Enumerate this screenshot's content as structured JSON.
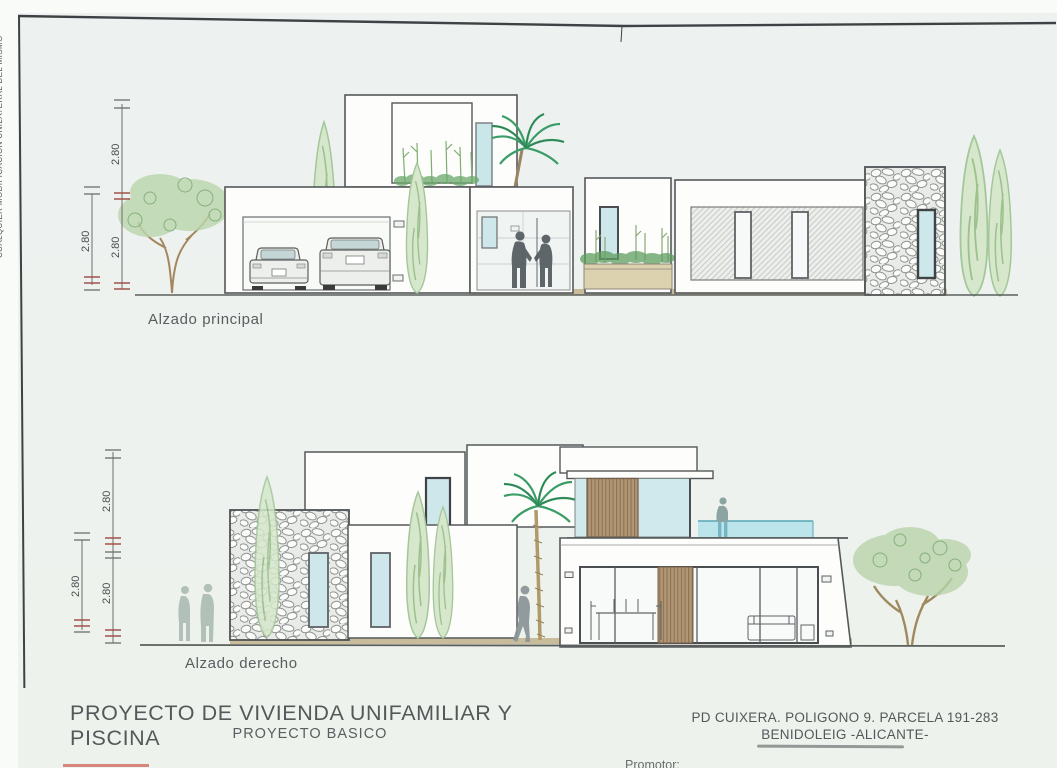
{
  "sheet": {
    "margin_text": "CUALQUIER MODIFICACION UNILATERAL DEL MISMO"
  },
  "elevation1": {
    "label": "Alzado principal",
    "dim_upper": "2.80",
    "dim_lower": "2.80",
    "dim_left": "2.80"
  },
  "elevation2": {
    "label": "Alzado derecho",
    "dim_upper": "2.80",
    "dim_lower": "2.80",
    "dim_left": "2.80"
  },
  "title_block": {
    "title": "PROYECTO DE VIVIENDA UNIFAMILIAR Y PISCINA",
    "subtitle": "PROYECTO BASICO",
    "location_line1": "PD CUIXERA. POLIGONO 9. PARCELA 191-283",
    "location_line2": "BENIDOLEIG -ALICANTE-",
    "promoter_label": "Promotor:"
  },
  "colors": {
    "paper": "#edf2ee",
    "line": "#55585a",
    "glass": "#cde7ea",
    "pool_water": "#b8e3ea",
    "wood_slats": "#b29674",
    "foliage": "#b9d3aa",
    "palm_green": "#3a9c66",
    "ground_strip": "#c9bc9b",
    "dimension_tick_red": "#a0524a",
    "red_mark": "#cf6a5e"
  }
}
